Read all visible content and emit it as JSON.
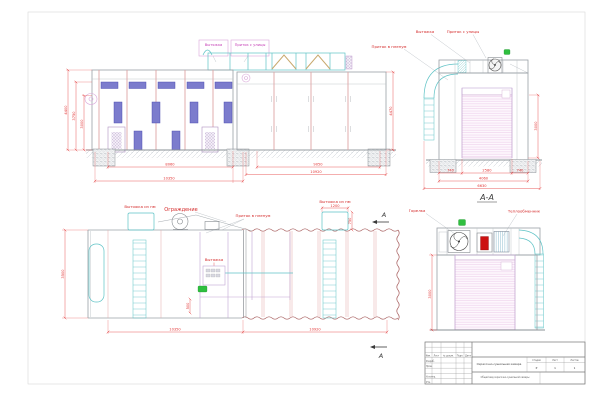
{
  "drawing": {
    "section_title": "А-А",
    "section_letter": "А"
  },
  "labels": {
    "front": {
      "exhaust": "Вытяжка",
      "intake_street": "Приток с улицы"
    },
    "side": {
      "exhaust": "Вытяжка",
      "intake_street": "Приток с улицы",
      "intake_plenum": "Приток в пленум"
    },
    "rear": {
      "exhaust_room_left": "Вытяжка из пм",
      "guard": "Ограждение",
      "intake_plenum": "Приток в пленум",
      "exhaust_room_right": "Вытяжка из пм",
      "exhaust_panel": "Вытяжка"
    },
    "section": {
      "burner": "Горелка",
      "heat_exchanger": "Теплообменник"
    }
  },
  "dims": {
    "front": {
      "inner_width": "8060",
      "outer_width": "10350",
      "h1": "4400",
      "h2": "3750",
      "h3": "3000"
    },
    "right": {
      "inner_width": "9050",
      "outer_width": "10920",
      "height": "4470"
    },
    "side": {
      "seg1": "740",
      "seg2": "2580",
      "seg3": "740",
      "mid_width": "4060",
      "outer_width": "6630",
      "height": "3000"
    },
    "rear": {
      "left_width": "10350",
      "right_width": "10920",
      "height": "3500",
      "duct_width": "1200",
      "duct_height": "750",
      "offset": "500"
    },
    "section": {
      "height": "3000"
    }
  },
  "title_block": {
    "cols": {
      "c1": "Изм.",
      "c2": "Лист",
      "c3": "№ докум.",
      "c4": "Подп.",
      "c5": "Дата"
    },
    "rows": {
      "r1": "Разраб.",
      "r2": "Пров.",
      "r3": "Н.контр.",
      "r4": "Утв."
    },
    "doc_name": "Окрасочно-сушильная камера",
    "view_name": "Общий вид окрасочно-сушильной камеры",
    "stage_label": "Стадия",
    "sheet_label": "Лист",
    "sheets_label": "Листов",
    "stage": "Р",
    "sheet_num": "1",
    "sheets_total": "1"
  }
}
